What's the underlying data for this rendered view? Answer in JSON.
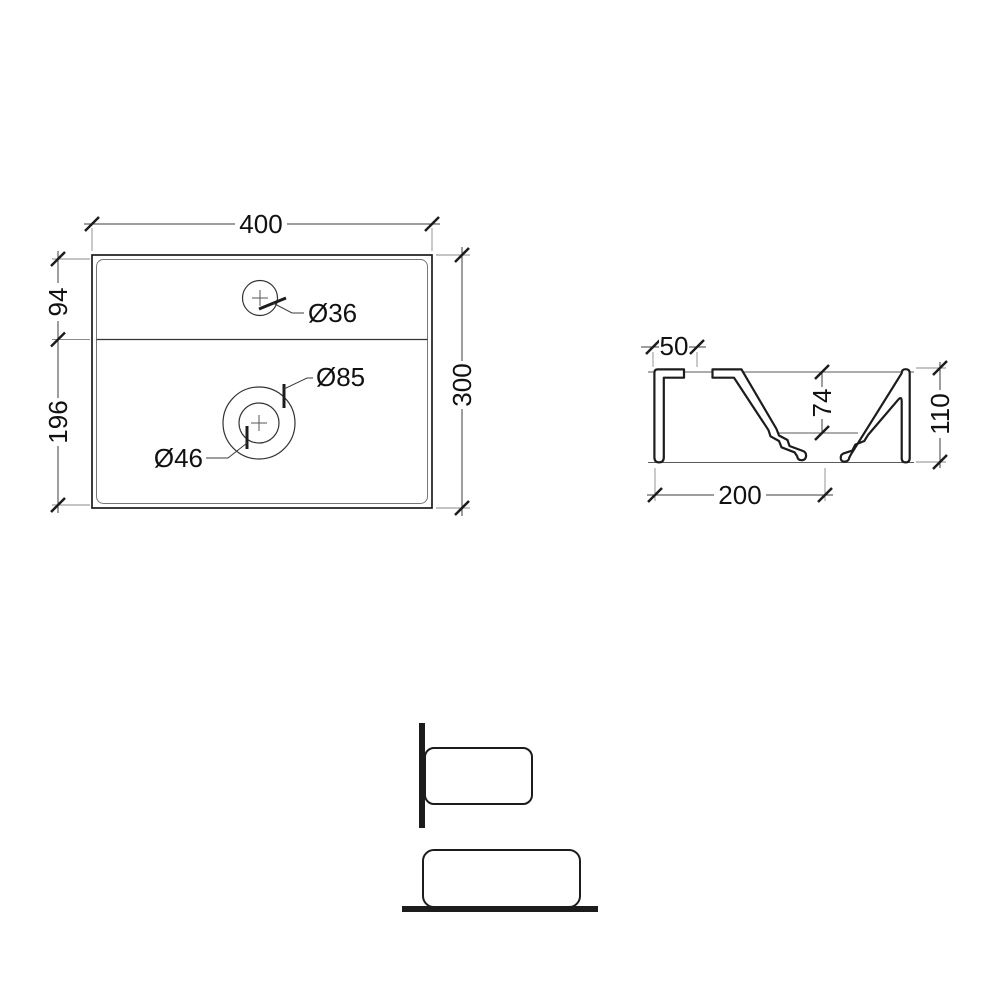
{
  "colors": {
    "background": "#ffffff",
    "ink": "#1c1c1c",
    "dim_line": "#3c3c3c"
  },
  "views": {
    "top": {
      "dims": {
        "width": "400",
        "height": "300",
        "back": "94",
        "front": "196"
      },
      "labels": {
        "faucet": "Ø36",
        "drain_outer": "Ø85",
        "drain_inner": "Ø46"
      }
    },
    "section": {
      "dims": {
        "rim": "50",
        "depth": "74",
        "height": "110",
        "width": "200"
      }
    }
  }
}
